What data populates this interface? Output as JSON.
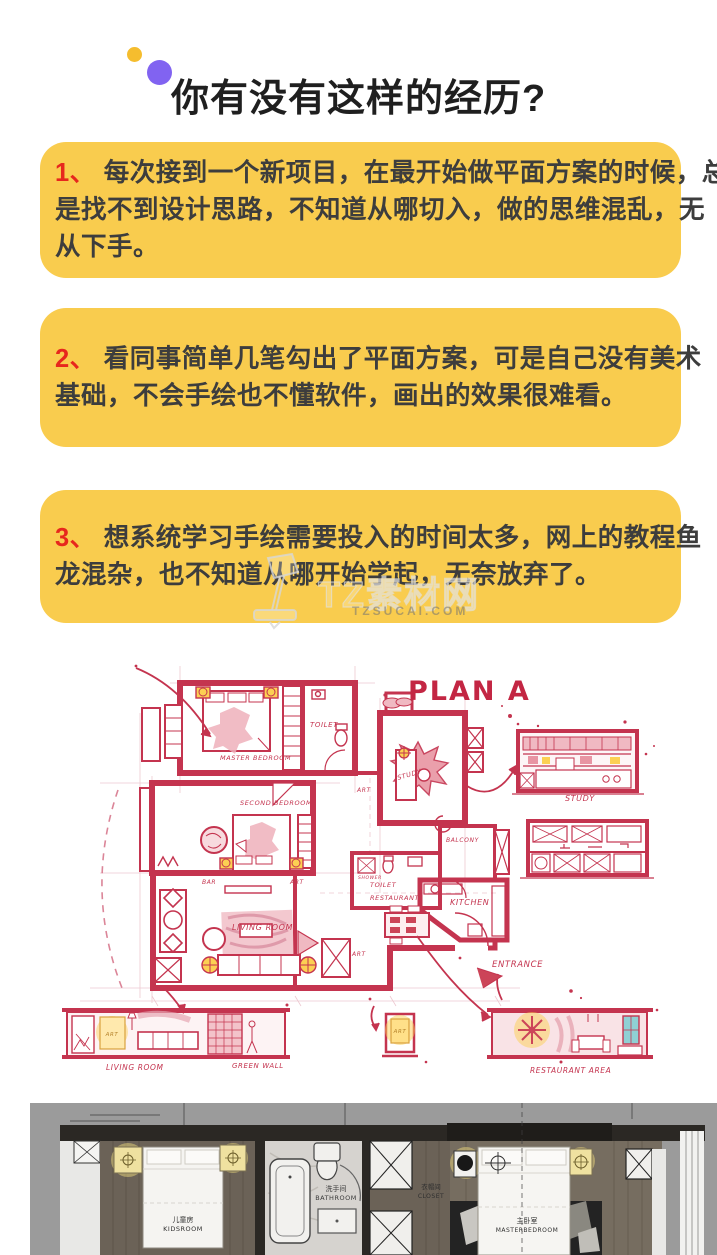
{
  "header": {
    "title": "你有没有这样的经历?",
    "dot_yellow_color": "#f5bd2e",
    "dot_purple_color": "#8163f1"
  },
  "pain_points": [
    {
      "num": "1、",
      "lines": [
        "每次接到一个新项目，在最开始做平面方案的时候，总",
        "是找不到设计思路，不知道从哪切入，做的思维混乱，无",
        "从下手。"
      ]
    },
    {
      "num": "2、",
      "lines": [
        "看同事简单几笔勾出了平面方案，可是自己没有美术",
        "基础，不会手绘也不懂软件，画出的效果很难看。"
      ]
    },
    {
      "num": "3、",
      "lines": [
        "想系统学习手绘需要投入的时间太多，网上的教程鱼",
        "龙混杂，也不知道从哪开始学起，无奈放弃了。"
      ]
    }
  ],
  "bubble_color": "#f9cc4e",
  "number_color": "#e7271d",
  "watermark": {
    "brand": "TZ素材网",
    "domain": "TZSUCAI.COM"
  },
  "sketch": {
    "accent_color": "#c4344f",
    "labels": {
      "plan_title": "PLAN A",
      "master_bedroom": "MASTER BEDROOM",
      "second_bedroom": "SECOND BEDROOM",
      "living_room": "LIVING ROOM",
      "toilet": "TOILET",
      "shower": "SHOWER",
      "study": "STUDY",
      "art": "ART",
      "bar": "BAR",
      "balcony": "BALCONY",
      "restaurant": "RESTAURANT",
      "kitchen": "KITCHEN",
      "entrance": "ENTRANCE",
      "study_elevation": "STUDY",
      "living_room_elevation": "LIVING ROOM",
      "green_wall": "GREEN WALL",
      "restaurant_area": "RESTAURANT AREA"
    }
  },
  "render_plan": {
    "rooms": {
      "kidsroom": {
        "cn": "儿童房",
        "en": "KIDSROOM"
      },
      "bathroom": {
        "cn": "洗手间",
        "en": "BATHROOM"
      },
      "closet": {
        "cn": "衣帽间",
        "en": "CLOSET"
      },
      "master": {
        "cn": "主卧室",
        "en": "MASTERBEDROOM"
      }
    }
  }
}
